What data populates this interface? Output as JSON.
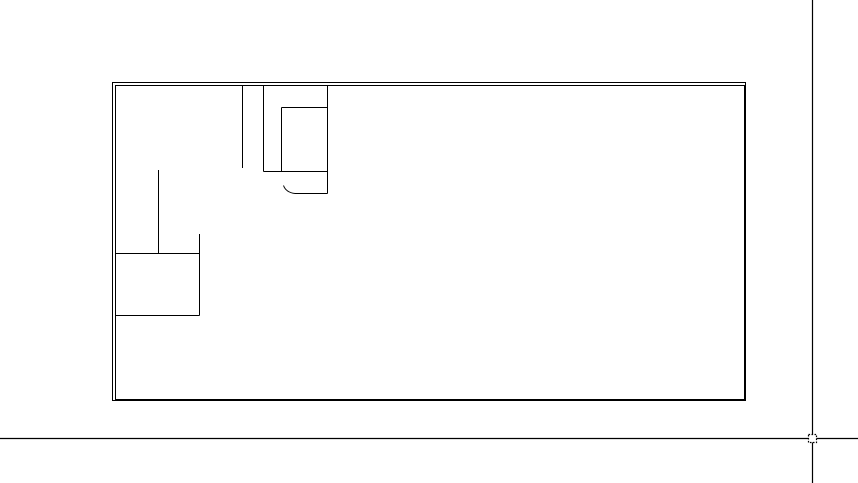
{
  "app": {
    "name": "cad-drawing-viewport",
    "description": "blank CAD model-space canvas showing a floor-plan line drawing with full-screen crosshair cursor"
  },
  "canvas": {
    "width": 858,
    "height": 483,
    "background_color": "#ffffff",
    "line_color": "#000000"
  },
  "crosshair": {
    "x": 812.5,
    "y": 438.5,
    "stroke_width": 1.2,
    "pickbox": {
      "cx": 812.5,
      "cy": 438.5,
      "size": 8
    }
  },
  "drawing": {
    "stroke_width": 1,
    "walls": {
      "outer": {
        "x": 112.5,
        "y": 82.5,
        "w": 633,
        "h": 318
      },
      "inner": {
        "x": 115.5,
        "y": 85.5,
        "w": 629,
        "h": 314
      }
    },
    "segments": [
      {
        "name": "partition-stub-vertical",
        "x1": 242.5,
        "y1": 86,
        "x2": 242.5,
        "y2": 168
      },
      {
        "name": "closet-left-wall",
        "x1": 263.5,
        "y1": 86,
        "x2": 263.5,
        "y2": 171.5
      },
      {
        "name": "closet-bottom-wall",
        "x1": 263.5,
        "y1": 171.5,
        "x2": 327.5,
        "y2": 171.5
      },
      {
        "name": "fixture-left-edge",
        "x1": 281.5,
        "y1": 107.5,
        "x2": 281.5,
        "y2": 171.5
      },
      {
        "name": "fixture-top-edge",
        "x1": 281.5,
        "y1": 107.5,
        "x2": 327.5,
        "y2": 107.5
      },
      {
        "name": "closet-right-wall",
        "x1": 327.5,
        "y1": 86,
        "x2": 327.5,
        "y2": 193.5
      },
      {
        "name": "door-leaf-line",
        "x1": 295,
        "y1": 193.5,
        "x2": 327.5,
        "y2": 193.5
      },
      {
        "name": "left-partition-vertical",
        "x1": 158.5,
        "y1": 170,
        "x2": 158.5,
        "y2": 253.5
      },
      {
        "name": "left-fixture-top-edge",
        "x1": 115.5,
        "y1": 253.5,
        "x2": 199.5,
        "y2": 253.5
      },
      {
        "name": "left-fixture-right-edge",
        "x1": 199.5,
        "y1": 234,
        "x2": 199.5,
        "y2": 315.5
      },
      {
        "name": "left-fixture-bottom-edge",
        "x1": 115.5,
        "y1": 315.5,
        "x2": 199.5,
        "y2": 315.5
      }
    ],
    "arcs": [
      {
        "name": "door-swing-arc",
        "path": "M 283.5,185.5 Q 286,192.5 295,193.5"
      }
    ]
  }
}
